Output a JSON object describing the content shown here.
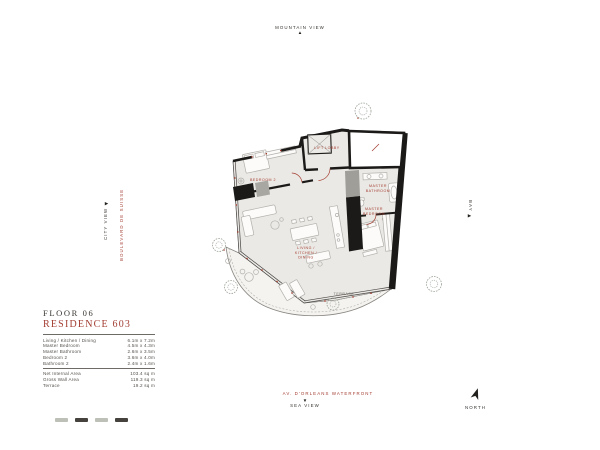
{
  "colors": {
    "accent_red": "#a33d31",
    "wall_black": "#1b1a18",
    "floor_gray": "#ebe9e5",
    "terrace_gray": "#f4f3f0",
    "furniture_gray": "#b2b0ab",
    "tree_green": "#9aa296"
  },
  "views": {
    "top": {
      "label": "MOUNTAIN VIEW",
      "arrow": "▲"
    },
    "bottom": {
      "label": "SEA VIEW",
      "arrow": "▼"
    },
    "left": {
      "label": "CITY VIEW",
      "arrow": "◀"
    },
    "right": {
      "label": "BAY",
      "arrow": "▶"
    }
  },
  "streets": {
    "left": "BOULEVARD DE SUISSE",
    "bottom": "AV. D'ORLEANS WATERFRONT"
  },
  "compass": {
    "label": "NORTH"
  },
  "title_block": {
    "floor_label": "FLOOR 06",
    "residence_label": "RESIDENCE 603",
    "dimension_rows": [
      {
        "label": "Living / Kitchen / Dining",
        "value": "6.1m x 7.2m"
      },
      {
        "label": "Master Bedroom",
        "value": "4.5m x 4.3m"
      },
      {
        "label": "Master Bathroom",
        "value": "2.6m x 3.5m"
      },
      {
        "label": "Bedroom 2",
        "value": "3.6m x 4.0m"
      },
      {
        "label": "Bathroom 2",
        "value": "2.4m x 1.6m"
      }
    ],
    "summary_rows": [
      {
        "label": "Net Internal Area",
        "value": "103.4 sq m"
      },
      {
        "label": "Gross Wall Area",
        "value": "119.3 sq m"
      },
      {
        "label": "Terrace",
        "value": "19.2 sq m"
      }
    ]
  },
  "plan": {
    "rooms": {
      "bedroom2": "BEDROOM 2",
      "lift_lobby": "LIFT LOBBY",
      "master_bathroom_1": "MASTER",
      "master_bathroom_2": "BATHROOM",
      "master_bedroom_1": "MASTER",
      "master_bedroom_2": "BEDROOM",
      "living_1": "LIVING /",
      "living_2": "KITCHEN /",
      "living_3": "DINING",
      "terrace": "TERRACE"
    }
  }
}
